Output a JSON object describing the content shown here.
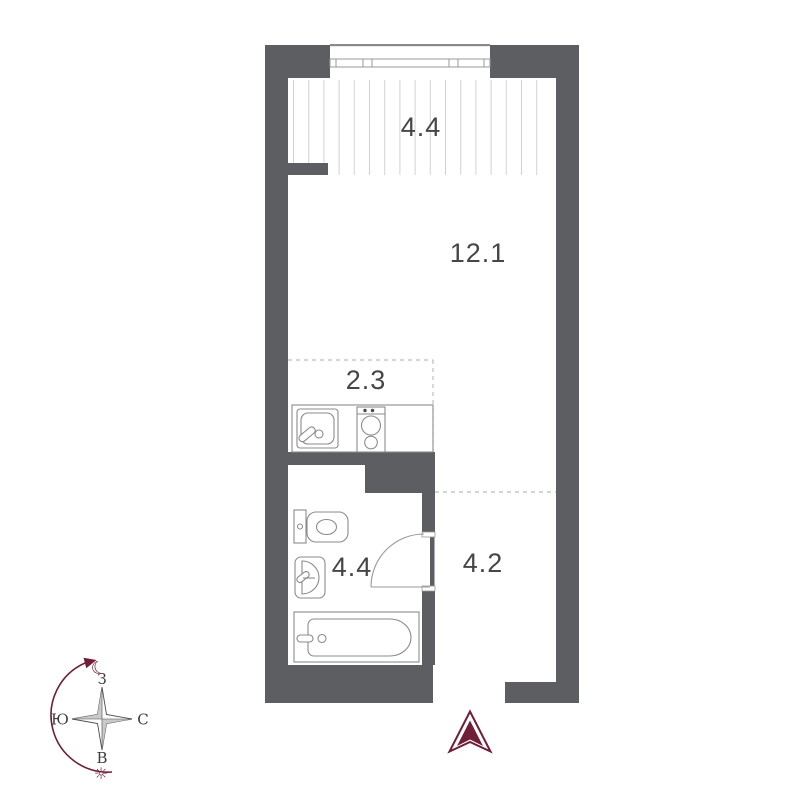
{
  "title": "studio-apartment-floor-plan",
  "colors": {
    "wall": "#5d5e61",
    "accent": "#6f2038",
    "fixture_line": "#8b8b8b",
    "hatch": "#d2d2d2",
    "dash": "#bdbdbd",
    "label": "#464646",
    "compass_line": "#4e4e4e"
  },
  "rooms": {
    "balcony": {
      "area": "4.4"
    },
    "living": {
      "area": "12.1"
    },
    "kitchen": {
      "area": "2.3"
    },
    "bathroom": {
      "area": "4.4"
    },
    "hallway": {
      "area": "4.2"
    }
  },
  "compass": {
    "top": "З",
    "right": "С",
    "bottom": "В",
    "left": "Ю",
    "moon": "☾",
    "sun": "☼"
  }
}
